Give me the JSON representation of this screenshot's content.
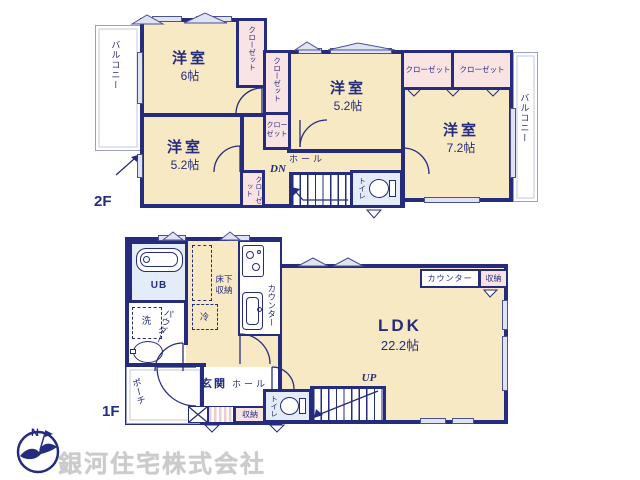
{
  "colors": {
    "wall": "#252c7d",
    "room_fill": "#f7e9c4",
    "closet_fill": "#f9e3e3",
    "wet_fill": "#e3ecf8",
    "window": "#dfe3f2",
    "watermark": "#cbcbcb"
  },
  "floor2": {
    "label": "2F",
    "room_6": {
      "name": "洋室",
      "size": "6帖"
    },
    "room_52_left": {
      "name": "洋室",
      "size": "5.2帖"
    },
    "room_52_top": {
      "name": "洋室",
      "size": "5.2帖"
    },
    "room_72": {
      "name": "洋室",
      "size": "7.2帖"
    },
    "balcony_left": "バルコニー",
    "balcony_right": "バルコニー",
    "closet": "クローゼット",
    "hall": "ホール",
    "toilet": "トイレ",
    "stairs_label": "DN"
  },
  "floor1": {
    "label": "1F",
    "ldk": {
      "name": "LDK",
      "size": "22.2帖"
    },
    "unit_bath": "UB",
    "laundry": "洗",
    "powder_room": "パウダールーム",
    "refrigerator": "冷",
    "underfloor_storage": "床下収納",
    "kitchen_counter": "カウンター",
    "ldk_counter": "カウンター",
    "ldk_storage": "収納",
    "hall_storage": "収納",
    "entrance": "玄関",
    "hall": "ホール",
    "toilet": "トイレ",
    "porch": "ポーチ",
    "stairs_label": "UP"
  },
  "compass": {
    "north_label": "N"
  },
  "watermark": "銀河住宅株式会社"
}
